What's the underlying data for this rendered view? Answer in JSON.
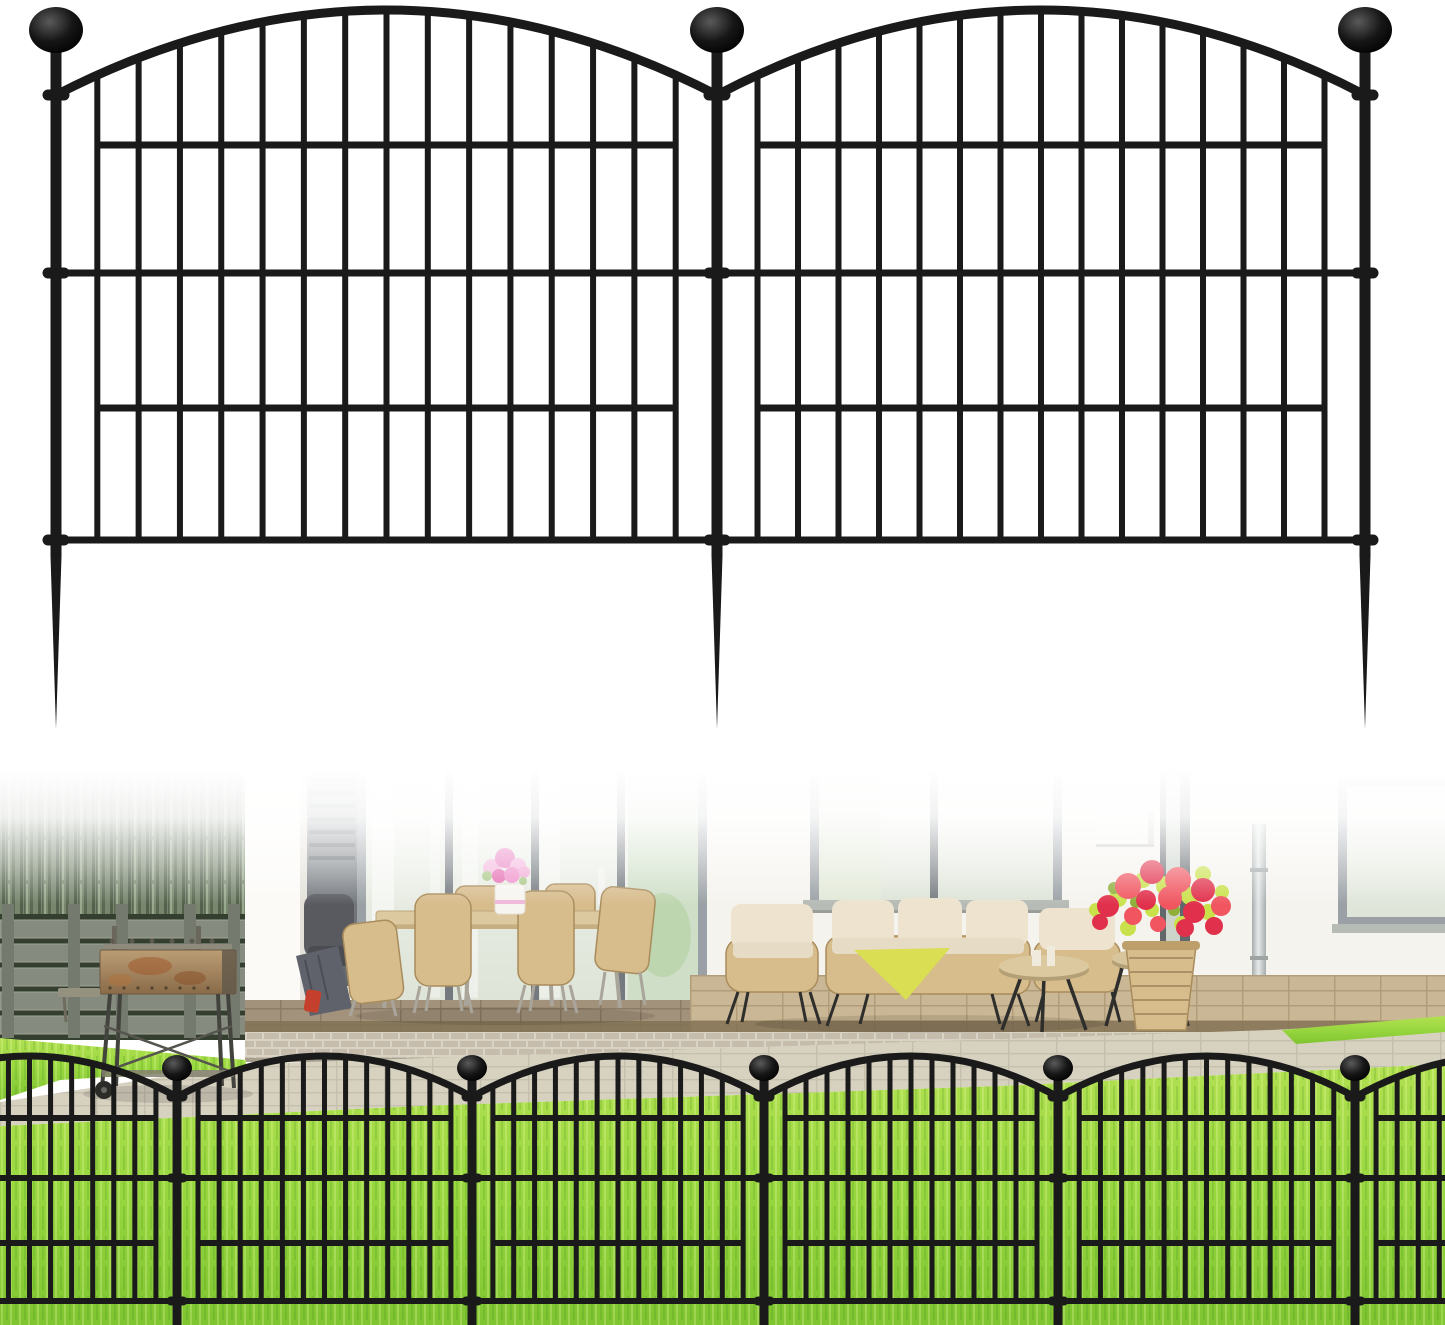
{
  "image": {
    "kind": "product-photo",
    "background": "#ffffff",
    "description": "Black metal decorative garden fence: top shows two arched no-dig panels with ball-finial posts and ground spikes on white; bottom shows the fence installed on a sunny lawn in front of a house patio with outdoor furniture"
  },
  "colors": {
    "fence_black": "#1a1a1a",
    "wall": "#f5f3ee",
    "pillar": "#fbfaf7",
    "pillar_shade": "#e4e1da",
    "gray_band_top": "#8b9095",
    "gray_band_bottom": "#63686d",
    "slat": "#565c61",
    "frame": "#9aa0a5",
    "frame_dark": "#73797e",
    "glass_top": "#f3f5ef",
    "glass_bottom": "#dee4d8",
    "glass_green": "#cfdfc7",
    "plant_green": "#b7d2a6",
    "sill": "#b7bbb5",
    "hedge_base": "#77866d",
    "hedge_dark": "#4e5c48",
    "hedge_light": "#9fb093",
    "wood": "#868b80",
    "wood_gap": "#343f30",
    "wood_post": "#757a6e",
    "tile_left": "#a3927b",
    "tile_left_line": "#8b7b66",
    "tile_right": "#cab795",
    "tile_right_line": "#b19d79",
    "tile_edge": "#837255",
    "brick": "#c5bcab",
    "brick_mortar": "#d9d3c5",
    "path": "#d7d1c0",
    "path_line": "#c5bfad",
    "lawn_top": "#b2e052",
    "lawn_mid": "#9ad840",
    "lawn_bottom": "#7fc531",
    "grass_light": "#f4ffb4",
    "grass_dark": "#2e7a12",
    "wicker": "#d7bc8c",
    "wicker_dark": "#a98c5c",
    "cushion": "#ede3ce",
    "seat": "#e6dbc4",
    "throw": "#d9de52",
    "table_top": "#dcc9a0",
    "table_rim": "#b4a076",
    "leg_dark": "#2e2e2c",
    "leg_light": "#a9a59b",
    "pink": "#e97fc3",
    "pink_light": "#f3b5dd",
    "red": "#e1304b",
    "red_light": "#f05560",
    "leaf": "#c9e24c",
    "leaf_dark": "#8fae3a",
    "rust_top": "#bb9d74",
    "rust_bottom": "#8a6b49",
    "rust_spot": "#a05a2b",
    "grill_leg": "#43433d",
    "pipe_light": "#e6e9e9",
    "pipe_dark": "#a6acac",
    "white_box": "#f7f6f2",
    "dark_chair": "#595a60",
    "lounger": "#60626b",
    "lounger_red": "#c5402c",
    "vase_white": "#f7f5f0"
  },
  "product_fence": {
    "style": "arched top",
    "finial": "ball",
    "ground_stake": "spike",
    "panels": 2,
    "posts": 3,
    "bars_per_panel": 15,
    "rails_per_panel": 4,
    "geometry": {
      "posts": [
        56,
        717,
        1365
      ],
      "ball_cy": 30,
      "ball_rx": 27,
      "ball_ry": 23,
      "arch_attach_y": 95,
      "arch_peak_y": 10,
      "arch_w": 9,
      "bars": 15,
      "bar_w": 6,
      "bar_bottom_y": 543,
      "rails": [
        [
          145,
          0
        ],
        [
          273,
          1
        ],
        [
          408,
          0
        ],
        [
          540,
          1
        ]
      ],
      "rail_h": 7,
      "post_w": 11,
      "post_bottom_y": 556,
      "spike_tip_y": 729,
      "rings": [
        95,
        273,
        540
      ],
      "ring_w": 27,
      "ring_h": 11
    }
  },
  "installed_fence": {
    "visible_ball_posts": 5,
    "bars_per_panel": 13,
    "rails_per_panel": 4,
    "geometry": {
      "posts": [
        -118,
        177,
        472,
        764,
        1058,
        1355,
        1650
      ],
      "ball_cy": 1068,
      "ball_rx": 15,
      "ball_ry": 13,
      "arch_attach_y": 1097,
      "arch_peak_y": 1056,
      "arch_w": 7,
      "bars": 13,
      "bar_w": 5,
      "bar_bottom_y": 1304,
      "rails": [
        [
          1118,
          0
        ],
        [
          1178,
          1
        ],
        [
          1243,
          0
        ],
        [
          1301,
          1
        ]
      ],
      "rail_h": 6,
      "post_w": 9,
      "post_bottom_y": 1325,
      "spike_tip_y": null,
      "rings": [
        1097,
        1178,
        1301
      ],
      "ring_w": 21,
      "ring_h": 9
    }
  },
  "scene": {
    "objects": [
      "ornamental-grass-hedge",
      "gray-wooden-slat-fence",
      "charcoal-bbq-grill",
      "white-house-wall",
      "corner-pillar",
      "vent-panel",
      "sliding-glass-doors",
      "dining-table",
      "wicker-dining-chairs",
      "pink-flower-bouquet",
      "dark-gray-chair",
      "folded-loungers",
      "lounge-window",
      "wall-speaker-box",
      "right-window",
      "downspout-pipe",
      "wicker-sofa",
      "wicker-armchairs",
      "yellow-throw-blanket",
      "round-side-tables",
      "wicker-planter-with-red-flowers",
      "patio-tiles",
      "brick-step",
      "stone-path",
      "sunny-lawn",
      "black-garden-fence-row"
    ]
  }
}
